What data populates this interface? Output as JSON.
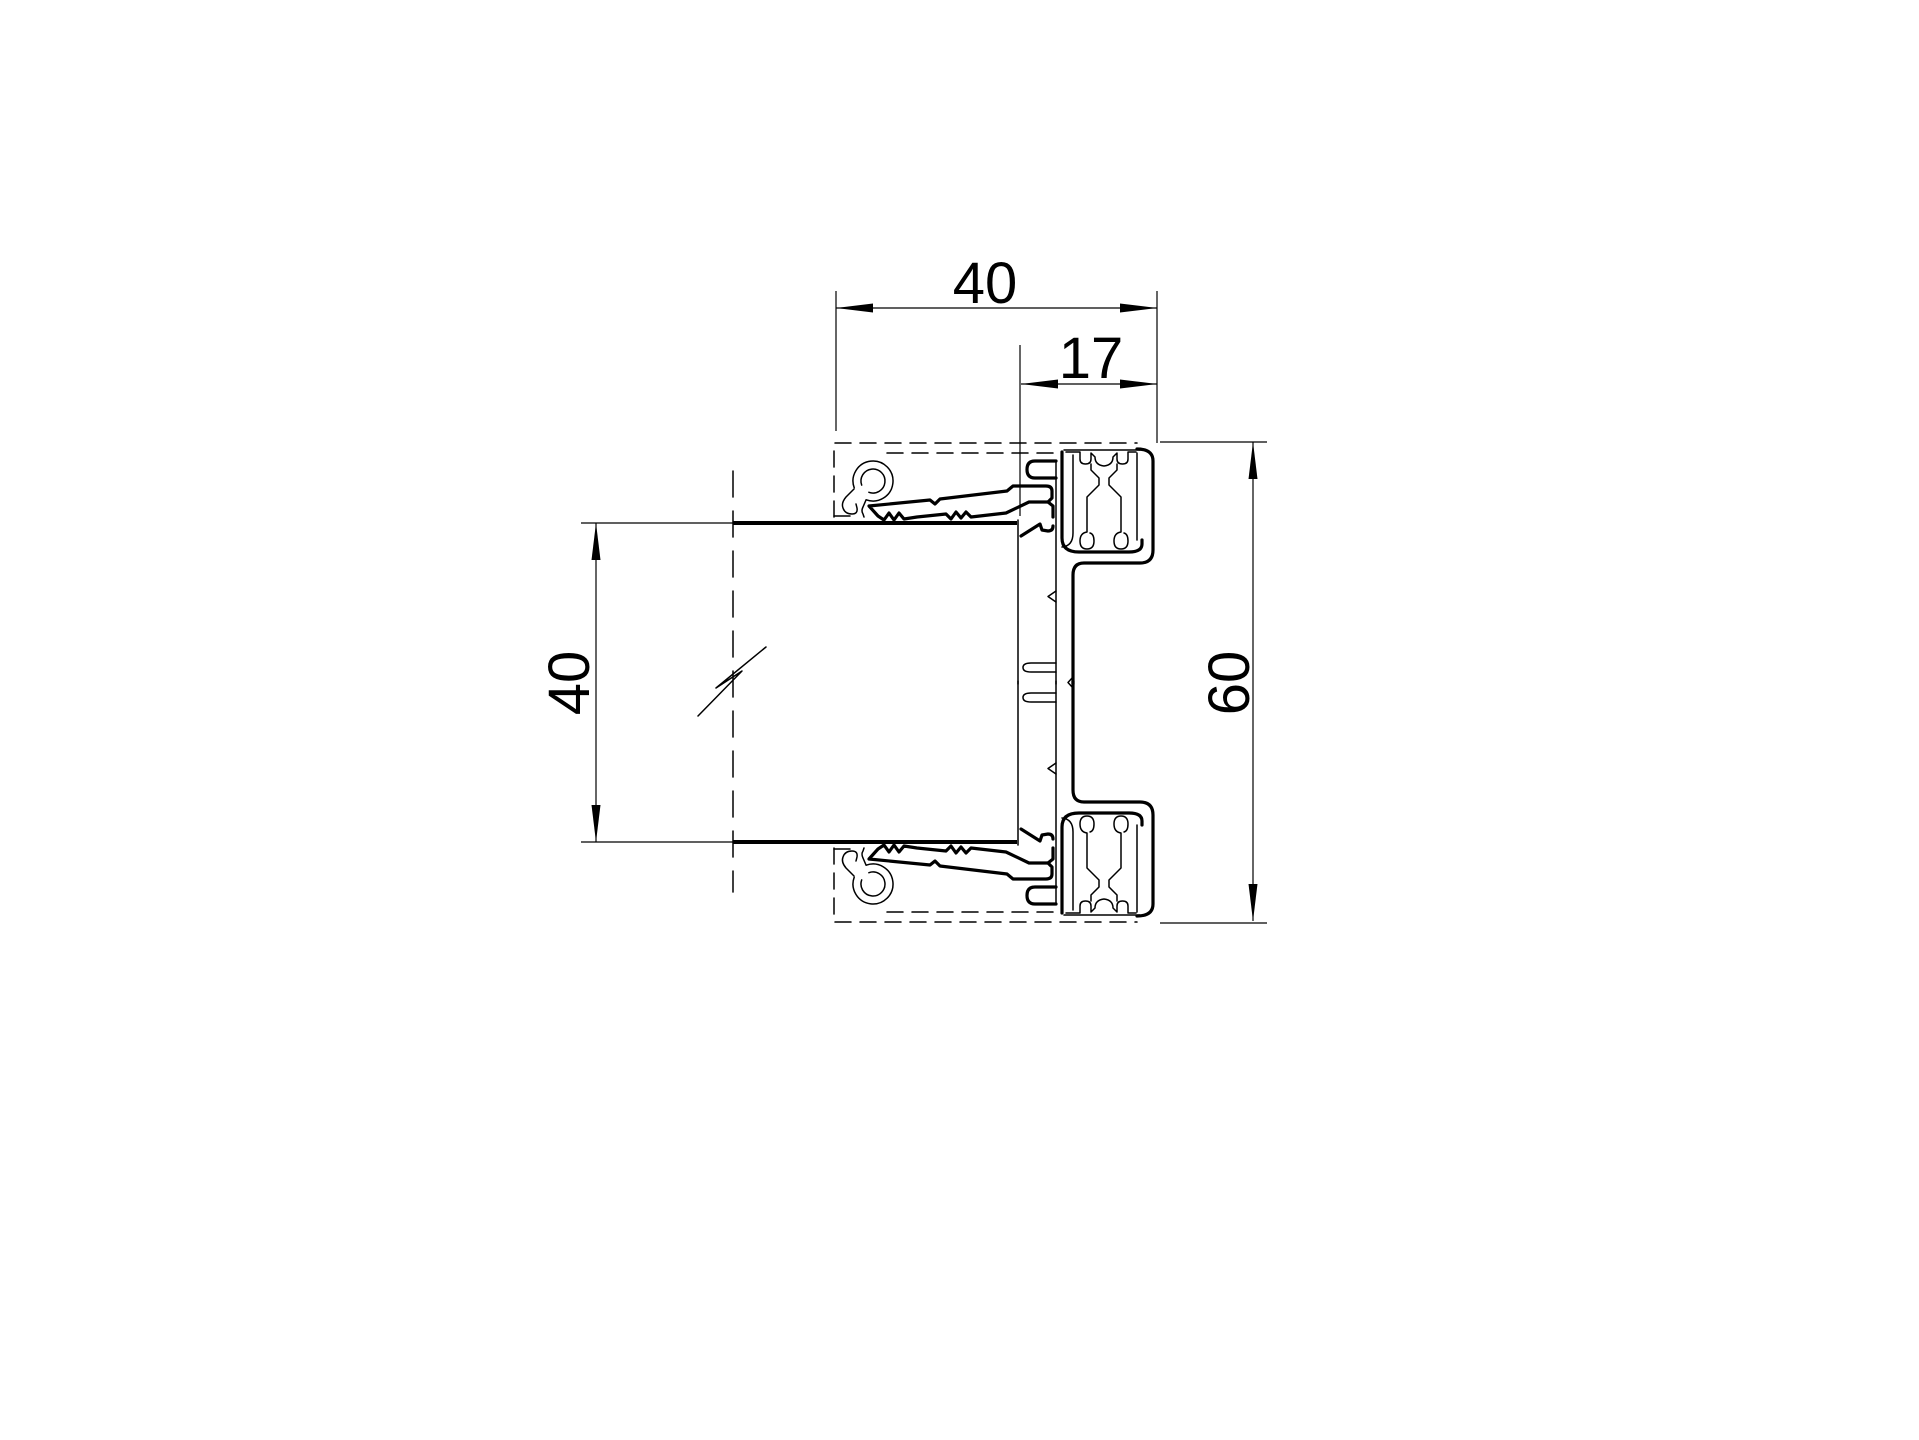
{
  "drawing": {
    "background": "#ffffff",
    "line_color": "#000000",
    "dimensions": {
      "top_width": {
        "label": "40"
      },
      "rebate_depth": {
        "label": "17"
      },
      "channel_opening": {
        "label": "40"
      },
      "profile_height": {
        "label": "60"
      }
    }
  }
}
